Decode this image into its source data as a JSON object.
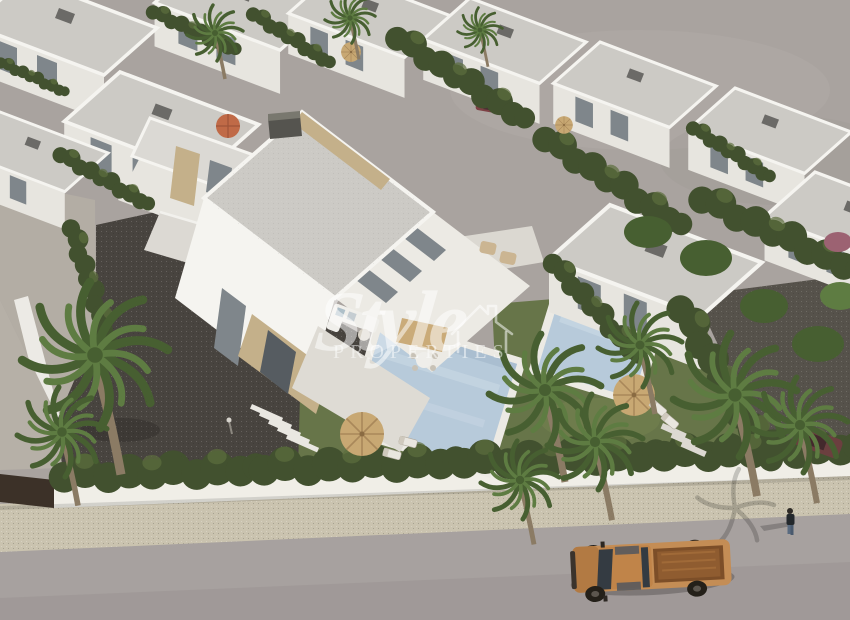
{
  "page": {
    "type": "real-estate-render-photo",
    "title": "Aerial 3D render of a new-build villa development with private pools"
  },
  "watermark": {
    "brand": "Style",
    "subtitle": "PROPERTIES",
    "icon": "house-outline-icon"
  },
  "scene": {
    "objects": [
      "main-semi-detached-villa",
      "neighbor-villas",
      "swimming-pool",
      "second-pool",
      "thatch-umbrellas",
      "orange-umbrella",
      "sun-loungers",
      "outdoor-sofa",
      "palm-trees",
      "cypress-hedges",
      "lawn",
      "gravel-driveway",
      "perimeter-wall",
      "sidewalk",
      "street",
      "bronze-pickup-truck",
      "pedestrian",
      "parked-cars",
      "bare-land"
    ]
  },
  "palette": {
    "land": "#a9a39f",
    "road": "#a7a19f",
    "roadDeep": "#9a9492",
    "sidewalk": "#cac3af",
    "wallWhite": "#f0eee7",
    "wallDark": "#3c3128",
    "hedge": "#42512f",
    "hedgeLight": "#5d6e3d",
    "lawn": "#677549",
    "lawnLight": "#768350",
    "gravel": "#48443f",
    "sand": "#b3ada4",
    "white": "#f5f4f0",
    "whiteShade": "#e7e5df",
    "roof": "#cccac5",
    "roofLight": "#dbd9d4",
    "stone": "#c4b08a",
    "window": "#7f868b",
    "windowDark": "#565c61",
    "pool": "#b7cada",
    "poolLight": "#ccdae6",
    "poolRim": "#eceae4",
    "palm": "#5e7c42",
    "palmDark": "#475f31",
    "palmLight": "#7c9a55",
    "trunk": "#8b7b64",
    "thatch": "#c8a873",
    "thatchDark": "#a9885a",
    "orange": "#c06a47",
    "truck": "#c48d55",
    "truckShade": "#b27a43",
    "truckBed": "#7c4e28",
    "glass": "#343b42",
    "wheel": "#242019",
    "wm": "rgba(255,255,255,0.52)"
  }
}
